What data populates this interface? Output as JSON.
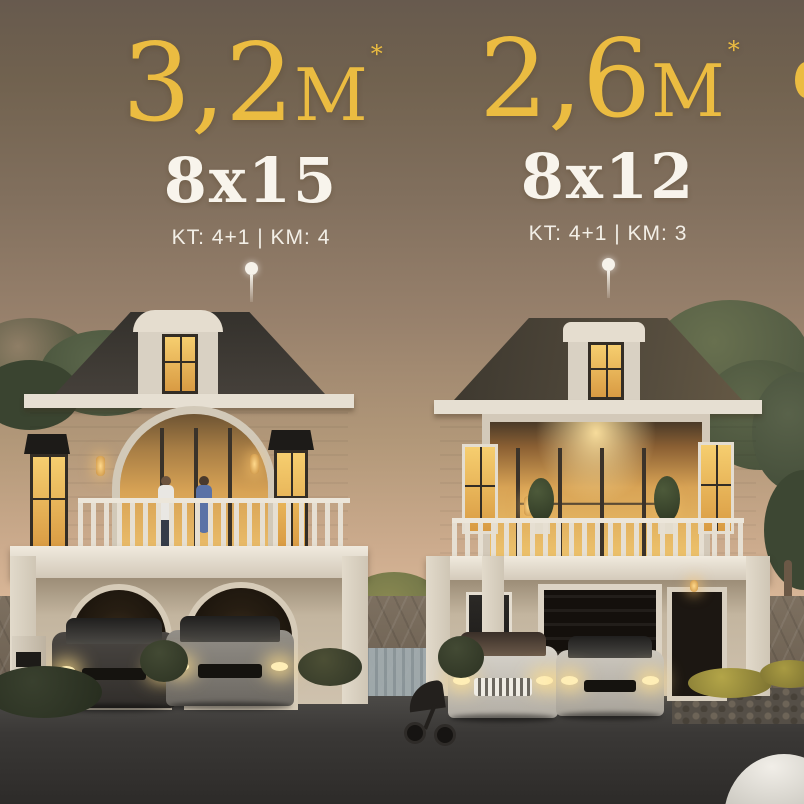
{
  "listings": [
    {
      "price_value": "3,2",
      "price_unit": "M",
      "price_superscript": "*",
      "dimensions": "8x15",
      "specs": "KT: 4+1 | KM: 4"
    },
    {
      "price_value": "2,6",
      "price_unit": "M",
      "price_superscript": "*",
      "dimensions": "8x12",
      "specs": "KT: 4+1 | KM: 3"
    }
  ],
  "colors": {
    "price_gold": "#ebbc41",
    "text_white": "#f7f3eb",
    "sky_top": "#675a4e",
    "sky_horizon": "#ecc9a8",
    "roof_dark": "#45403a",
    "wall_cream": "#d8cfc0",
    "window_glow": "#f2c05e",
    "road_asphalt": "#3a3836"
  }
}
